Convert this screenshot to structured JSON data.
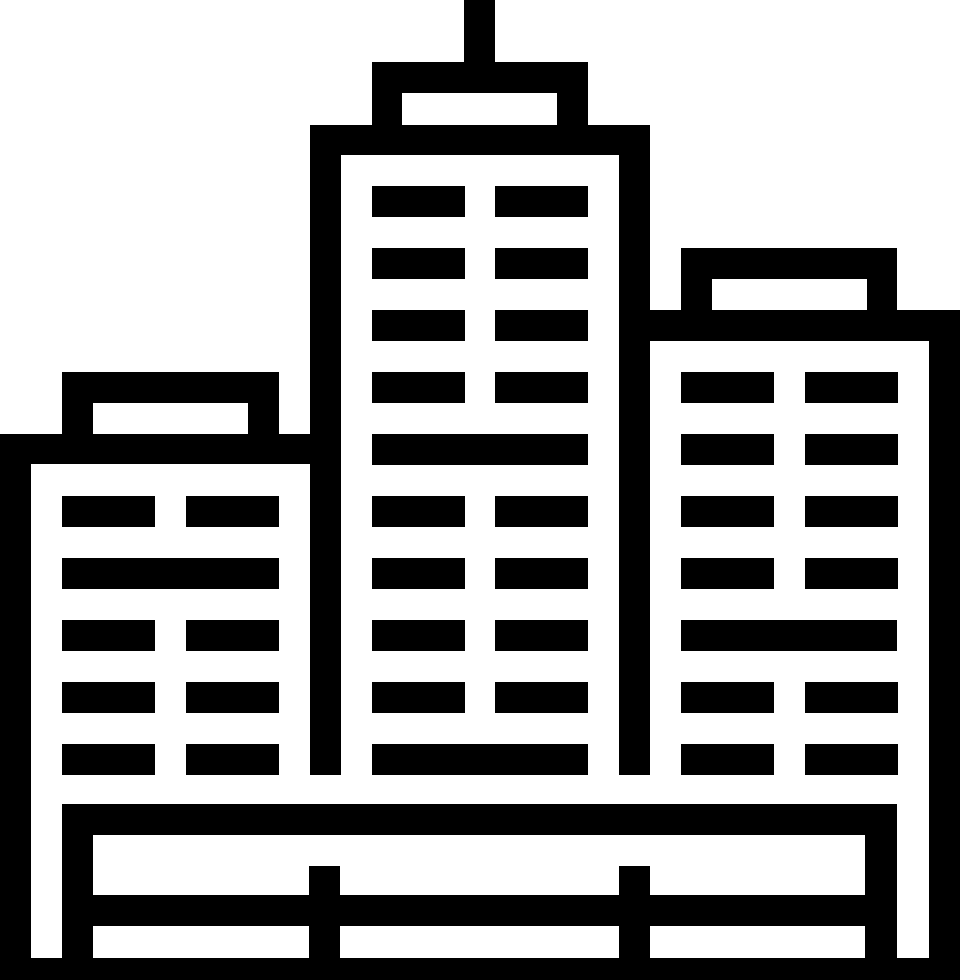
{
  "icon": {
    "name": "city-buildings",
    "description": "Black outline pictogram of three city buildings: a tall central skyscraper with a rooftop antenna, shorter buildings on the left and right, rows of rectangular windows, and a fenced ground platform at the bottom",
    "color": "#000000",
    "background": "#ffffff",
    "viewbox": "0 0 960 980",
    "canvas": {
      "width": 960,
      "height": 980
    },
    "rects": [
      {
        "name": "center-tower-antenna",
        "x": 464,
        "y": 0,
        "w": 31,
        "h": 63,
        "fill": "fg"
      },
      {
        "name": "center-tower-roof-box",
        "x": 372,
        "y": 62,
        "w": 216,
        "h": 63,
        "fill": "fg"
      },
      {
        "name": "center-tower-roof-window",
        "x": 402,
        "y": 93,
        "w": 155,
        "h": 32,
        "fill": "bg"
      },
      {
        "name": "center-tower-top-bar",
        "x": 310,
        "y": 125,
        "w": 340,
        "h": 30,
        "fill": "fg"
      },
      {
        "name": "center-tower-wall-left",
        "x": 310,
        "y": 125,
        "w": 31,
        "h": 650,
        "fill": "fg"
      },
      {
        "name": "center-tower-wall-right",
        "x": 619,
        "y": 125,
        "w": 31,
        "h": 650,
        "fill": "fg"
      },
      {
        "name": "center-tower-window",
        "x": 372,
        "y": 186,
        "w": 93,
        "h": 31,
        "fill": "fg"
      },
      {
        "name": "center-tower-window",
        "x": 495,
        "y": 186,
        "w": 93,
        "h": 31,
        "fill": "fg"
      },
      {
        "name": "center-tower-window",
        "x": 372,
        "y": 248,
        "w": 93,
        "h": 31,
        "fill": "fg"
      },
      {
        "name": "center-tower-window",
        "x": 495,
        "y": 248,
        "w": 93,
        "h": 31,
        "fill": "fg"
      },
      {
        "name": "center-tower-window",
        "x": 372,
        "y": 310,
        "w": 93,
        "h": 31,
        "fill": "fg"
      },
      {
        "name": "center-tower-window",
        "x": 495,
        "y": 310,
        "w": 93,
        "h": 31,
        "fill": "fg"
      },
      {
        "name": "center-tower-window",
        "x": 372,
        "y": 372,
        "w": 93,
        "h": 31,
        "fill": "fg"
      },
      {
        "name": "center-tower-window",
        "x": 495,
        "y": 372,
        "w": 93,
        "h": 31,
        "fill": "fg"
      },
      {
        "name": "center-tower-floor-band",
        "x": 372,
        "y": 434,
        "w": 216,
        "h": 31,
        "fill": "fg"
      },
      {
        "name": "center-tower-window",
        "x": 372,
        "y": 496,
        "w": 93,
        "h": 31,
        "fill": "fg"
      },
      {
        "name": "center-tower-window",
        "x": 495,
        "y": 496,
        "w": 93,
        "h": 31,
        "fill": "fg"
      },
      {
        "name": "center-tower-window",
        "x": 372,
        "y": 558,
        "w": 93,
        "h": 31,
        "fill": "fg"
      },
      {
        "name": "center-tower-window",
        "x": 495,
        "y": 558,
        "w": 93,
        "h": 31,
        "fill": "fg"
      },
      {
        "name": "center-tower-window",
        "x": 372,
        "y": 620,
        "w": 93,
        "h": 31,
        "fill": "fg"
      },
      {
        "name": "center-tower-window",
        "x": 495,
        "y": 620,
        "w": 93,
        "h": 31,
        "fill": "fg"
      },
      {
        "name": "center-tower-window",
        "x": 372,
        "y": 682,
        "w": 93,
        "h": 31,
        "fill": "fg"
      },
      {
        "name": "center-tower-window",
        "x": 495,
        "y": 682,
        "w": 93,
        "h": 31,
        "fill": "fg"
      },
      {
        "name": "center-tower-floor-band",
        "x": 372,
        "y": 744,
        "w": 216,
        "h": 31,
        "fill": "fg"
      },
      {
        "name": "left-building-roof-box",
        "x": 62,
        "y": 372,
        "w": 217,
        "h": 62,
        "fill": "fg"
      },
      {
        "name": "left-building-roof-window",
        "x": 93,
        "y": 403,
        "w": 155,
        "h": 31,
        "fill": "bg"
      },
      {
        "name": "left-building-top-bar",
        "x": 0,
        "y": 434,
        "w": 310,
        "h": 30,
        "fill": "fg"
      },
      {
        "name": "left-building-wall",
        "x": 0,
        "y": 434,
        "w": 31,
        "h": 546,
        "fill": "fg"
      },
      {
        "name": "left-building-window",
        "x": 62,
        "y": 496,
        "w": 93,
        "h": 31,
        "fill": "fg"
      },
      {
        "name": "left-building-window",
        "x": 186,
        "y": 496,
        "w": 93,
        "h": 31,
        "fill": "fg"
      },
      {
        "name": "left-building-floor-band",
        "x": 62,
        "y": 558,
        "w": 217,
        "h": 31,
        "fill": "fg"
      },
      {
        "name": "left-building-window",
        "x": 62,
        "y": 620,
        "w": 93,
        "h": 31,
        "fill": "fg"
      },
      {
        "name": "left-building-window",
        "x": 186,
        "y": 620,
        "w": 93,
        "h": 31,
        "fill": "fg"
      },
      {
        "name": "left-building-window",
        "x": 62,
        "y": 682,
        "w": 93,
        "h": 31,
        "fill": "fg"
      },
      {
        "name": "left-building-window",
        "x": 186,
        "y": 682,
        "w": 93,
        "h": 31,
        "fill": "fg"
      },
      {
        "name": "left-building-window",
        "x": 62,
        "y": 744,
        "w": 93,
        "h": 31,
        "fill": "fg"
      },
      {
        "name": "left-building-window",
        "x": 186,
        "y": 744,
        "w": 93,
        "h": 31,
        "fill": "fg"
      },
      {
        "name": "right-building-roof-box",
        "x": 681,
        "y": 248,
        "w": 216,
        "h": 62,
        "fill": "fg"
      },
      {
        "name": "right-building-roof-window",
        "x": 712,
        "y": 279,
        "w": 155,
        "h": 31,
        "fill": "bg"
      },
      {
        "name": "right-building-top-bar",
        "x": 650,
        "y": 310,
        "w": 310,
        "h": 31,
        "fill": "fg"
      },
      {
        "name": "right-building-wall",
        "x": 929,
        "y": 310,
        "w": 31,
        "h": 670,
        "fill": "fg"
      },
      {
        "name": "right-building-window",
        "x": 681,
        "y": 372,
        "w": 93,
        "h": 31,
        "fill": "fg"
      },
      {
        "name": "right-building-window",
        "x": 805,
        "y": 372,
        "w": 93,
        "h": 31,
        "fill": "fg"
      },
      {
        "name": "right-building-window",
        "x": 681,
        "y": 434,
        "w": 93,
        "h": 31,
        "fill": "fg"
      },
      {
        "name": "right-building-window",
        "x": 805,
        "y": 434,
        "w": 93,
        "h": 31,
        "fill": "fg"
      },
      {
        "name": "right-building-window",
        "x": 681,
        "y": 496,
        "w": 93,
        "h": 31,
        "fill": "fg"
      },
      {
        "name": "right-building-window",
        "x": 805,
        "y": 496,
        "w": 93,
        "h": 31,
        "fill": "fg"
      },
      {
        "name": "right-building-window",
        "x": 681,
        "y": 558,
        "w": 93,
        "h": 31,
        "fill": "fg"
      },
      {
        "name": "right-building-window",
        "x": 805,
        "y": 558,
        "w": 93,
        "h": 31,
        "fill": "fg"
      },
      {
        "name": "right-building-floor-band",
        "x": 681,
        "y": 620,
        "w": 216,
        "h": 31,
        "fill": "fg"
      },
      {
        "name": "right-building-window",
        "x": 681,
        "y": 682,
        "w": 93,
        "h": 31,
        "fill": "fg"
      },
      {
        "name": "right-building-window",
        "x": 805,
        "y": 682,
        "w": 93,
        "h": 31,
        "fill": "fg"
      },
      {
        "name": "right-building-window",
        "x": 681,
        "y": 744,
        "w": 93,
        "h": 31,
        "fill": "fg"
      },
      {
        "name": "right-building-window",
        "x": 805,
        "y": 744,
        "w": 93,
        "h": 31,
        "fill": "fg"
      },
      {
        "name": "base-pillar-left",
        "x": 62,
        "y": 804,
        "w": 31,
        "h": 176,
        "fill": "fg"
      },
      {
        "name": "base-pillar-right",
        "x": 865,
        "y": 804,
        "w": 32,
        "h": 176,
        "fill": "fg"
      },
      {
        "name": "base-top-rail",
        "x": 62,
        "y": 804,
        "w": 835,
        "h": 31,
        "fill": "fg"
      },
      {
        "name": "base-middle-rail",
        "x": 62,
        "y": 895,
        "w": 835,
        "h": 31,
        "fill": "fg"
      },
      {
        "name": "fence-post-left",
        "x": 309,
        "y": 866,
        "w": 31,
        "h": 114,
        "fill": "fg"
      },
      {
        "name": "fence-post-right",
        "x": 619,
        "y": 866,
        "w": 31,
        "h": 114,
        "fill": "fg"
      },
      {
        "name": "base-bottom-bar",
        "x": 0,
        "y": 958,
        "w": 960,
        "h": 22,
        "fill": "fg"
      }
    ]
  }
}
